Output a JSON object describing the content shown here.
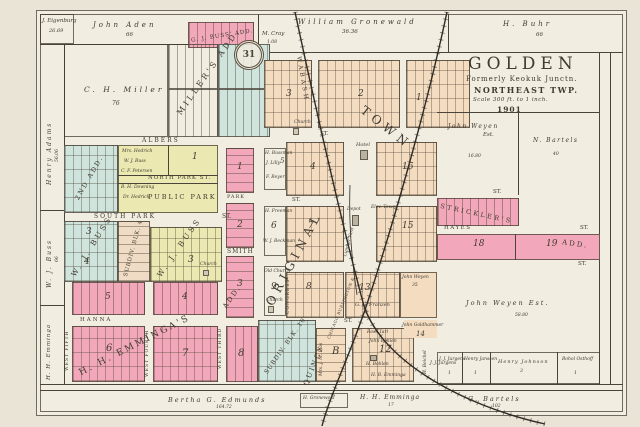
{
  "palette": {
    "paper": "#e9e4d6",
    "map_bg": "#f1ede1",
    "pink": "#f2a8ba",
    "blue": "#cfe4dd",
    "yellow": "#ebe8b1",
    "tan": "#f4dcc1",
    "line": "#4a443a"
  },
  "title": {
    "main": "GOLDEN",
    "formerly": "Formerly Keokuk Junctn.",
    "township": "NORTHEAST TWP.",
    "scale": "Scale 300 ft. to 1 inch.",
    "year": "1901"
  },
  "stamp": {
    "number": "31"
  },
  "border_parcels": {
    "eigenburg": "J. Eigenburg",
    "eigenburg_acres": "26.69",
    "aden": "John Aden",
    "aden_acres": "66",
    "mcray": "M. Cray",
    "mcray_acres": "1.08",
    "gronewald": "William Gronewald",
    "gronewald_acres": "36.36",
    "buhr": "H. Buhr",
    "buhr_acres": "66",
    "adams": "Henry Adams",
    "adams_acres": "56.06",
    "wj_buss": "W. J. Buss",
    "wj_buss_acres": "66",
    "hh_emminga": "H. H. Emminga",
    "edmunds": "Bertha G. Edmunds",
    "edmunds_acres": "164.72",
    "g_bartels": "G. Bartels",
    "g_bartels_acres": "102"
  },
  "right_side": {
    "weyen_upper": "John Weyen",
    "weyen_upper_est": "Est.",
    "weyen_upper_acres": "16.80",
    "n_bartels": "N. Bartels",
    "n_bartels_acres": "40",
    "weyen_lower": "John Weyen Est.",
    "weyen_lower_acres": "58.80",
    "jj_jurgens": "J. J. Jurgens",
    "jj_jurgens_acres": "1",
    "janssen": "Henry Janssen",
    "janssen_acres": "1",
    "johnson": "Henry Johnson",
    "johnson_acres": "3",
    "osthoff": "Bohol Osthoff",
    "osthoff_acres": "1"
  },
  "additions": {
    "gj_buss": "G. J. BUSS' ADD.",
    "millers": "MILLER'S ADD.",
    "second_add": "2ND ADD.",
    "wj_buss": "W. J. BUSS",
    "subdiv_blk4": "SUBDIV. BLK. 4",
    "subdiv_blk10": "SUBDIV. BLK. 10",
    "emmingas": "H. H. EMMINGA'S",
    "add": "ADD.",
    "original": "ORIGINAL",
    "town": "TOWN",
    "stricklers": "STRICKLER'S"
  },
  "streets": {
    "albers": "ALBERS",
    "north_park": "NORTH PARK ST.",
    "public_park": "PUBLIC PARK",
    "south_park": "SOUTH PARK",
    "st": "ST.",
    "smith": "SMITH",
    "park": "PARK",
    "hanna": "HANNA",
    "west_fifth": "WEST FIFTH",
    "west_fourth": "WEST FOURTH",
    "west_third": "WEST THIRD",
    "congress": "CONGRESS",
    "hayes": "HAYES"
  },
  "railroads": {
    "wabash": "WABASH",
    "cbq_line1": "CHICAGO BURLINGTON &",
    "cbq_line2": "QUINCY"
  },
  "town": {
    "miller": "C. H. Miller",
    "miller_acres": "76",
    "hedrich": "Mrs. Hedrich",
    "wj_buss": "W. J. Buss",
    "petersen": "C. F. Petersen",
    "downing": "B. H. Downing",
    "dr_hedrick": "Dr. Hedrick",
    "bussman": "H. Bussman",
    "lilly": "J. Lilly",
    "beyer": "F. Beyer",
    "freeman": "H. Freeman",
    "beckman": "W. J. Beckman",
    "old_church": "Old Church",
    "church": "Church",
    "hotel": "Hotel",
    "depot": "Depot",
    "elev_tower": "Elev. Tower",
    "lumber_yard": "Lumber Yard",
    "franzen": "G. G. Franzen",
    "weyen": "John Weyen",
    "weyen_acres": "35",
    "flos": "Mrs. J. M. Flos",
    "ross_tarl": "Ross Tarl",
    "bohlen": "John Bohlen",
    "h_bohlen": "H. Bohlen",
    "hb_emminga": "H. B. Emminga",
    "goldhammer": "John Goldhammer",
    "jurgens": "J. J. Jurgens",
    "beichel": "H. Beichel",
    "hh_emminga": "H. H. Emminga",
    "hh_emminga_acres": "17",
    "gronewold": "H. Gronewold"
  },
  "blocks": {
    "n1": "1",
    "n2": "2",
    "n3": "3",
    "n4": "4",
    "n5": "5",
    "n6": "6",
    "n7": "7",
    "n8": "8",
    "n9": "9",
    "n12": "12",
    "n13": "13",
    "n14": "14",
    "n15": "15",
    "n16": "16",
    "n18": "18",
    "n19": "19",
    "letter_b": "B"
  }
}
